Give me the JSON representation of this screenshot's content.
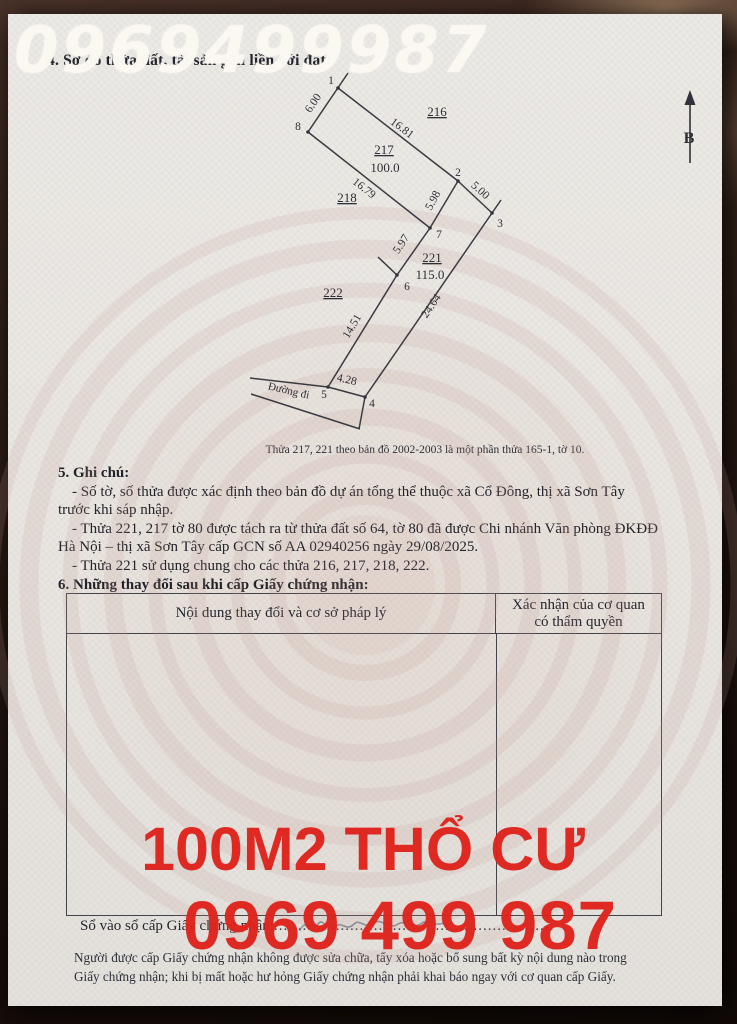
{
  "watermarks": {
    "top_phone": "0969499987",
    "area_label": "100M2 THỔ CƯ",
    "phone": "0969 499 987",
    "red_color": "#df231c",
    "white_color": "#fbf8f2"
  },
  "sections": {
    "s4_title": "4. Sơ đồ thửa đất, tài sản gắn liền với đất:",
    "s5_title": "5. Ghi chú:",
    "s5_lines": [
      "- Số tờ, số thửa được xác định theo bản đồ dự án tổng thể thuộc xã Cổ Đông, thị xã Sơn Tây",
      "trước khi sáp nhập.",
      "- Thửa 221, 217 tờ 80 được tách ra từ thửa đất số 64, tờ 80 đã được Chi nhánh Văn phòng ĐKĐĐ",
      "Hà Nội – thị xã Sơn Tây cấp GCN số AA 02940256 ngày 29/08/2025.",
      "- Thửa 221 sử dụng chung cho các thửa 216, 217, 218, 222."
    ],
    "s6_title": "6. Những thay đổi sau khi cấp Giấy chứng nhận:"
  },
  "map": {
    "north_label": "B",
    "road_label": "Đường đi",
    "caption": "Thửa 217, 221 theo bản đồ 2002-2003 là một phần thửa 165-1, tờ 10.",
    "parcel_labels": {
      "p216": "216",
      "p217": "217",
      "p217_area": "100.0",
      "p218": "218",
      "p221": "221",
      "p221_area": "115.0",
      "p222": "222"
    },
    "point_labels": [
      "1",
      "2",
      "3",
      "4",
      "5",
      "6",
      "7",
      "8"
    ],
    "dimensions": {
      "d1_8": "6.00",
      "d1_2": "16.81",
      "d8_7": "16.79",
      "d2_3": "5.00",
      "d2_7": "5.98",
      "d7_6": "5.97",
      "d3_4": "24.64",
      "d6_5": "14.51",
      "d5_4": "4.28"
    }
  },
  "table": {
    "col1_header": "Nội dung thay đổi và cơ sở pháp lý",
    "col2_header": "Xác nhận của cơ quan có thẩm quyền"
  },
  "footer": {
    "register_label": "Sổ vào sổ cấp Giấy chứng nhận:",
    "register_dots": "...........................................................",
    "note_line1": "Người được cấp Giấy chứng nhận không được sửa chữa, tẩy xóa hoặc bổ sung bất kỳ nội dung nào trong",
    "note_line2": "Giấy chứng nhận; khi bị mất hoặc hư hỏng Giấy chứng nhận phải khai báo ngay với cơ quan cấp Giấy."
  }
}
